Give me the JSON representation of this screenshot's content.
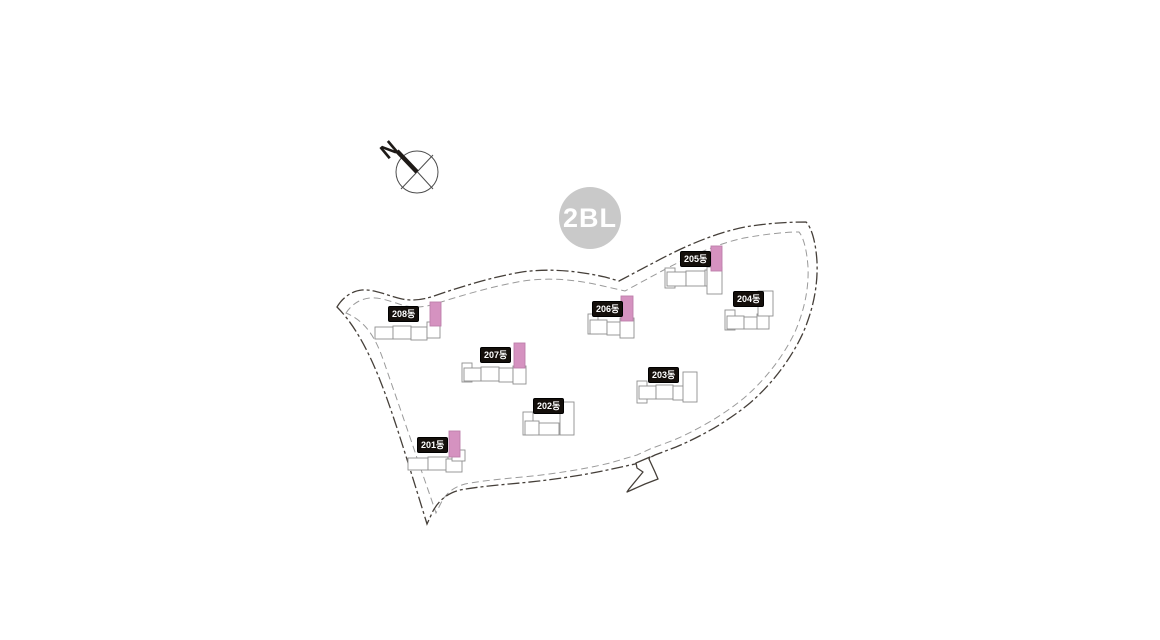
{
  "canvas": {
    "width": 1160,
    "height": 640,
    "background": "#ffffff"
  },
  "colors": {
    "boundary_outer": "#453f39",
    "boundary_inner": "#9a9a9a",
    "building_outline": "#8f8f8f",
    "building_fill": "#ffffff",
    "highlight_fill": "#d592c0",
    "highlight_stroke": "#bd7fab",
    "label_bg": "#140f0b",
    "label_text": "#ffffff",
    "badge_bg": "#c9c9c9",
    "badge_text": "#ffffff",
    "compass_stroke": "#4d4d4d",
    "compass_pointer": "#1e1a17"
  },
  "badge": {
    "label": "2BL",
    "cx": 590,
    "cy": 218,
    "r": 31
  },
  "compass": {
    "label": "N",
    "cx": 417,
    "cy": 172,
    "r": 21
  },
  "buildings": [
    {
      "name": "201동",
      "highlighted": true,
      "label": {
        "x": 417,
        "y": 437
      },
      "bar": {
        "x": 449,
        "y": 431,
        "w": 11,
        "h": 26
      },
      "units": [
        [
          408,
          458,
          20,
          12
        ],
        [
          428,
          457,
          20,
          13
        ],
        [
          446,
          459,
          16,
          13
        ],
        [
          452,
          450,
          13,
          11
        ]
      ]
    },
    {
      "name": "202동",
      "highlighted": false,
      "label": {
        "x": 533,
        "y": 398
      },
      "bar": null,
      "units": [
        [
          523,
          412,
          10,
          23
        ],
        [
          525,
          421,
          14,
          14
        ],
        [
          539,
          423,
          20,
          12
        ],
        [
          560,
          402,
          14,
          33
        ]
      ]
    },
    {
      "name": "203동",
      "highlighted": false,
      "label": {
        "x": 648,
        "y": 367
      },
      "bar": null,
      "units": [
        [
          637,
          381,
          10,
          22
        ],
        [
          639,
          386,
          17,
          13
        ],
        [
          656,
          385,
          17,
          14
        ],
        [
          673,
          386,
          11,
          14
        ],
        [
          683,
          372,
          14,
          30
        ]
      ]
    },
    {
      "name": "204동",
      "highlighted": false,
      "label": {
        "x": 733,
        "y": 291
      },
      "bar": null,
      "units": [
        [
          725,
          310,
          10,
          20
        ],
        [
          727,
          316,
          17,
          13
        ],
        [
          744,
          317,
          15,
          12
        ],
        [
          757,
          314,
          12,
          15
        ],
        [
          758,
          291,
          15,
          25
        ]
      ]
    },
    {
      "name": "205동",
      "highlighted": true,
      "label": {
        "x": 680,
        "y": 251
      },
      "bar": {
        "x": 711,
        "y": 246,
        "w": 11,
        "h": 25
      },
      "units": [
        [
          665,
          268,
          10,
          20
        ],
        [
          667,
          272,
          19,
          14
        ],
        [
          686,
          271,
          19,
          15
        ],
        [
          705,
          270,
          12,
          16
        ],
        [
          707,
          267,
          15,
          27
        ]
      ]
    },
    {
      "name": "206동",
      "highlighted": true,
      "label": {
        "x": 592,
        "y": 301
      },
      "bar": {
        "x": 621,
        "y": 296,
        "w": 12,
        "h": 25
      },
      "units": [
        [
          588,
          314,
          10,
          20
        ],
        [
          590,
          320,
          17,
          14
        ],
        [
          607,
          322,
          16,
          13
        ],
        [
          620,
          318,
          14,
          20
        ]
      ]
    },
    {
      "name": "207동",
      "highlighted": true,
      "label": {
        "x": 480,
        "y": 347
      },
      "bar": {
        "x": 514,
        "y": 343,
        "w": 11,
        "h": 25
      },
      "units": [
        [
          462,
          363,
          10,
          19
        ],
        [
          464,
          368,
          17,
          13
        ],
        [
          481,
          367,
          18,
          14
        ],
        [
          499,
          368,
          14,
          14
        ],
        [
          513,
          366,
          13,
          18
        ]
      ]
    },
    {
      "name": "208동",
      "highlighted": true,
      "label": {
        "x": 388,
        "y": 306
      },
      "bar": {
        "x": 430,
        "y": 302,
        "w": 11,
        "h": 24
      },
      "units": [
        [
          375,
          327,
          18,
          12
        ],
        [
          393,
          326,
          18,
          13
        ],
        [
          411,
          327,
          16,
          13
        ],
        [
          427,
          322,
          13,
          16
        ]
      ]
    }
  ]
}
